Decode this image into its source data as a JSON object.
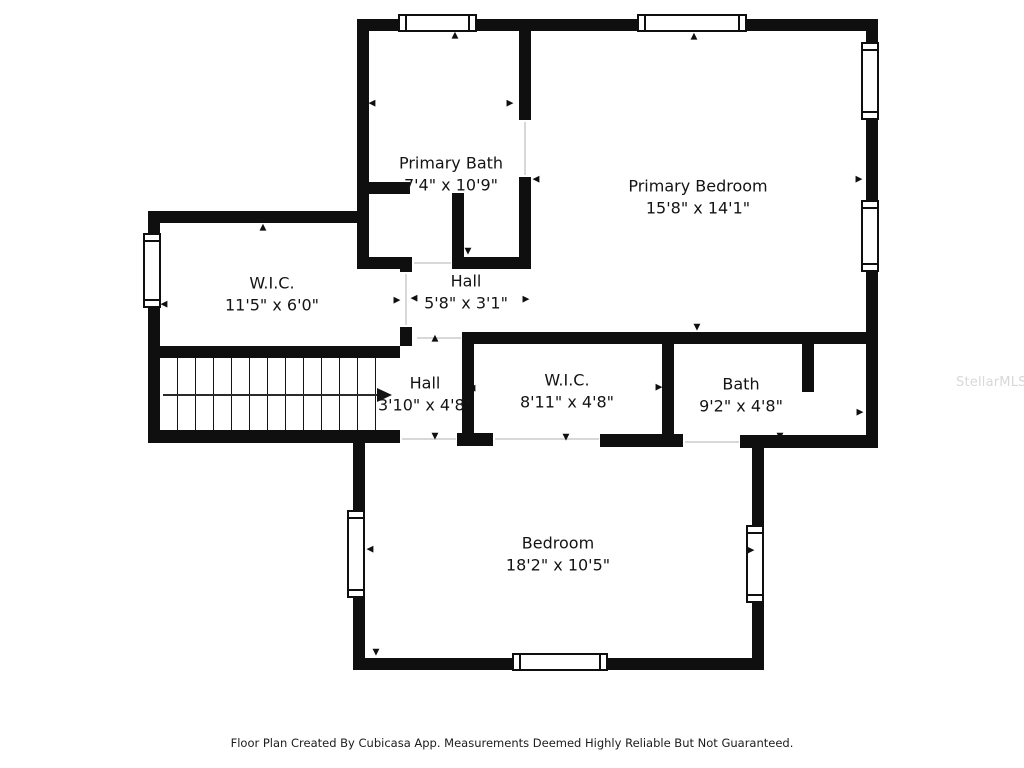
{
  "rooms": [
    {
      "name": "Primary Bath",
      "dims": "7'4\" x 10'9\""
    },
    {
      "name": "Primary Bedroom",
      "dims": "15'8\" x 14'1\""
    },
    {
      "name": "W.I.C.",
      "dims": "11'5\" x 6'0\""
    },
    {
      "name": "Hall",
      "dims": "5'8\" x 3'1\""
    },
    {
      "name": "Hall",
      "dims": "3'10\" x 4'8\""
    },
    {
      "name": "W.I.C.",
      "dims": "8'11\" x 4'8\""
    },
    {
      "name": "Bath",
      "dims": "9'2\" x 4'8\""
    },
    {
      "name": "Bedroom",
      "dims": "18'2\" x 10'5\""
    }
  ],
  "icons": {
    "up": "▲",
    "down": "▼",
    "left": "◀",
    "right": "▶"
  },
  "footer": {
    "text": "Floor Plan Created By Cubicasa App. Measurements Deemed Highly Reliable But Not Guaranteed."
  },
  "watermark": {
    "text": "StellarMLS"
  },
  "colors": {
    "wall": "#0f0f0f",
    "background": "#ffffff",
    "threshold": "#d8d8d8",
    "watermark": "#d8d8d8"
  }
}
